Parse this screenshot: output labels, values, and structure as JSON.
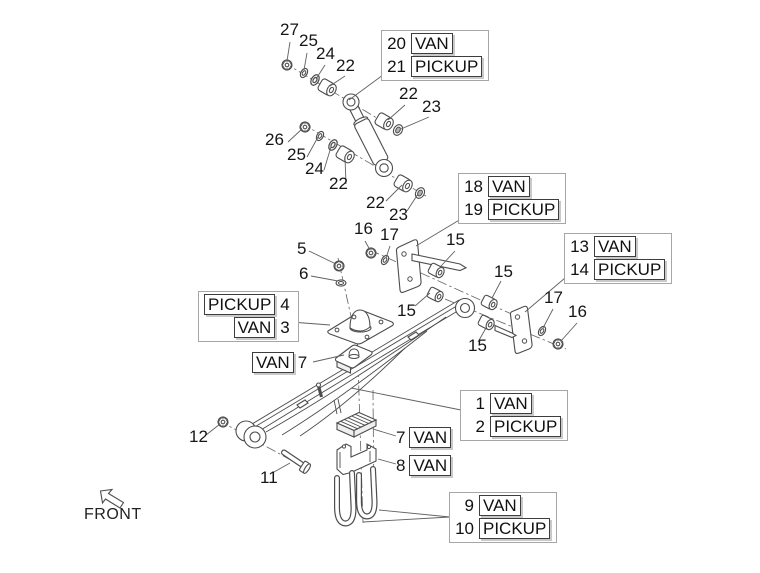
{
  "diagram": {
    "title_hidden": "",
    "front_indicator": {
      "label": "FRONT"
    },
    "part_labels": [
      {
        "t": "27"
      },
      {
        "t": "25"
      },
      {
        "t": "24"
      },
      {
        "t": "22"
      },
      {
        "t": "22"
      },
      {
        "t": "23"
      },
      {
        "t": "26"
      },
      {
        "t": "25"
      },
      {
        "t": "24"
      },
      {
        "t": "22"
      },
      {
        "t": "22"
      },
      {
        "t": "23"
      },
      {
        "t": "16"
      },
      {
        "t": "17"
      },
      {
        "t": "5"
      },
      {
        "t": "6"
      },
      {
        "t": "15"
      },
      {
        "t": "15"
      },
      {
        "t": "15"
      },
      {
        "t": "15"
      },
      {
        "t": "17"
      },
      {
        "t": "16"
      },
      {
        "t": "12"
      },
      {
        "t": "11"
      }
    ],
    "callouts": {
      "shock": {
        "rows": [
          {
            "n": "20",
            "t": "VAN"
          },
          {
            "n": "21",
            "t": "PICKUP"
          }
        ]
      },
      "hanger": {
        "rows": [
          {
            "n": "18",
            "t": "VAN"
          },
          {
            "n": "19",
            "t": "PICKUP"
          }
        ]
      },
      "shackle": {
        "rows": [
          {
            "n": "13",
            "t": "VAN"
          },
          {
            "n": "14",
            "t": "PICKUP"
          }
        ]
      },
      "bump_plate": {
        "rows": [
          {
            "t": "PICKUP",
            "n": "4"
          },
          {
            "t": "VAN",
            "n": "3"
          }
        ]
      },
      "spring": {
        "rows": [
          {
            "n": "1",
            "t": "VAN"
          },
          {
            "n": "2",
            "t": "PICKUP"
          }
        ]
      },
      "u_bolts": {
        "rows": [
          {
            "n": "9",
            "t": "VAN"
          },
          {
            "n": "10",
            "t": "PICKUP"
          }
        ]
      },
      "pad_upper": {
        "t": "VAN",
        "n": "7"
      },
      "clamp_pad": {
        "n": "7",
        "t": "VAN"
      },
      "clamp_bracket": {
        "n": "8",
        "t": "VAN"
      }
    },
    "colors": {
      "background": "#ffffff",
      "line": "#4d4d4d",
      "label": "#161616",
      "callout_border": "#a6a6a6",
      "tag_border": "#3d3d3d",
      "tag_shadow": "#c9c9c9"
    }
  }
}
